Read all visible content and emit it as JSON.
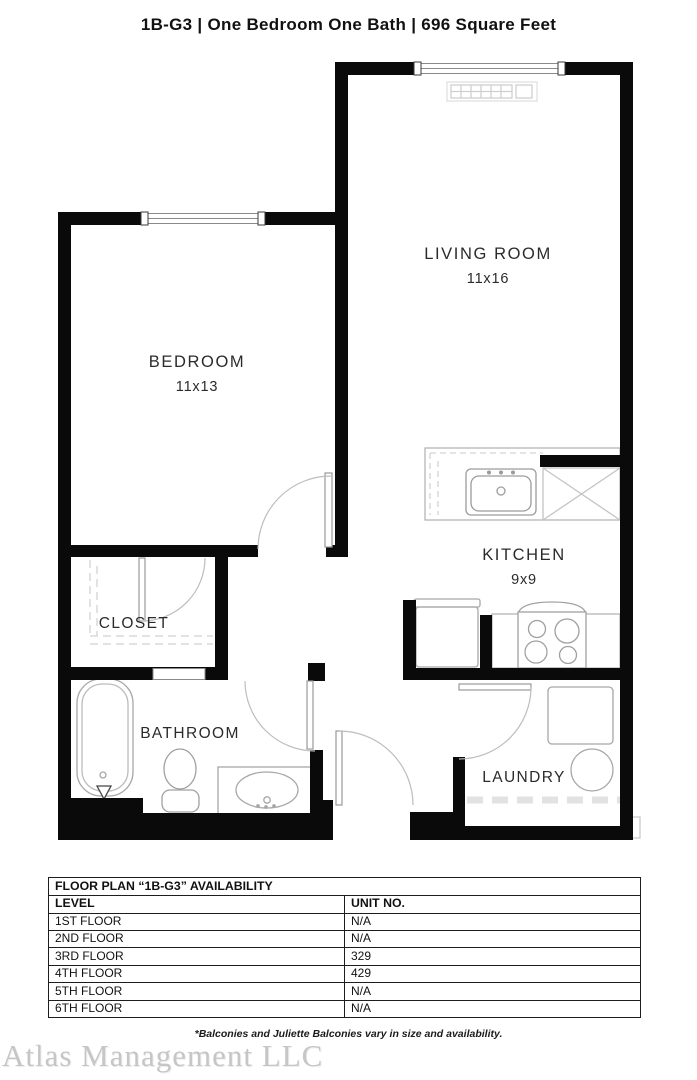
{
  "title": "1B-G3  | One Bedroom One Bath |  696 Square Feet",
  "rooms": {
    "living_room": {
      "name": "LIVING ROOM",
      "dims": "11x16"
    },
    "bedroom": {
      "name": "BEDROOM",
      "dims": "11x13"
    },
    "kitchen": {
      "name": "KITCHEN",
      "dims": "9x9"
    },
    "closet": {
      "name": "CLOSET"
    },
    "bathroom": {
      "name": "BATHROOM"
    },
    "laundry": {
      "name": "LAUNDRY"
    }
  },
  "availability_table": {
    "title": "FLOOR PLAN “1B-G3” AVAILABILITY",
    "columns": [
      "LEVEL",
      "UNIT NO."
    ],
    "rows": [
      {
        "level": "1ST FLOOR",
        "unit": "N/A"
      },
      {
        "level": "2ND FLOOR",
        "unit": "N/A"
      },
      {
        "level": "3RD FLOOR",
        "unit": "329"
      },
      {
        "level": "4TH FLOOR",
        "unit": "429"
      },
      {
        "level": "5TH FLOOR",
        "unit": "N/A"
      },
      {
        "level": "6TH FLOOR",
        "unit": "N/A"
      }
    ]
  },
  "footnote": "*Balconies and Juliette Balconies vary in size and availability.",
  "watermark": "Atlas Management LLC",
  "colors": {
    "wall": "#0a0a0a",
    "fixture": "#a8a8a8",
    "accent_text": "#2b2b2b"
  }
}
